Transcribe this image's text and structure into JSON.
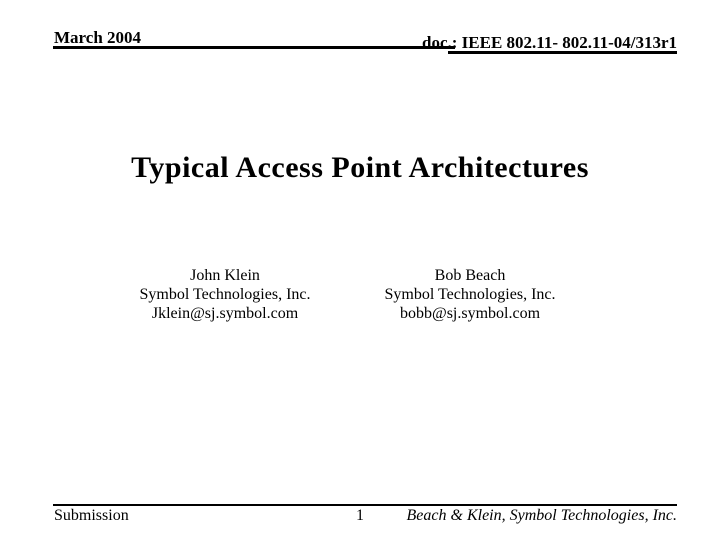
{
  "page": {
    "background_color": "#ffffff",
    "text_color": "#000000"
  },
  "header": {
    "date": "March 2004",
    "doc_number": "doc.: IEEE 802.11- 802.11-04/313r1"
  },
  "title": "Typical Access Point Architectures",
  "authors": [
    {
      "name": "John Klein",
      "organization": "Symbol Technologies, Inc.",
      "email": "Jklein@sj.symbol.com"
    },
    {
      "name": "Bob Beach",
      "organization": "Symbol Technologies, Inc.",
      "email": "bobb@sj.symbol.com"
    }
  ],
  "footer": {
    "left": "Submission",
    "page_number": "1",
    "right": "Beach & Klein, Symbol Technologies, Inc."
  }
}
